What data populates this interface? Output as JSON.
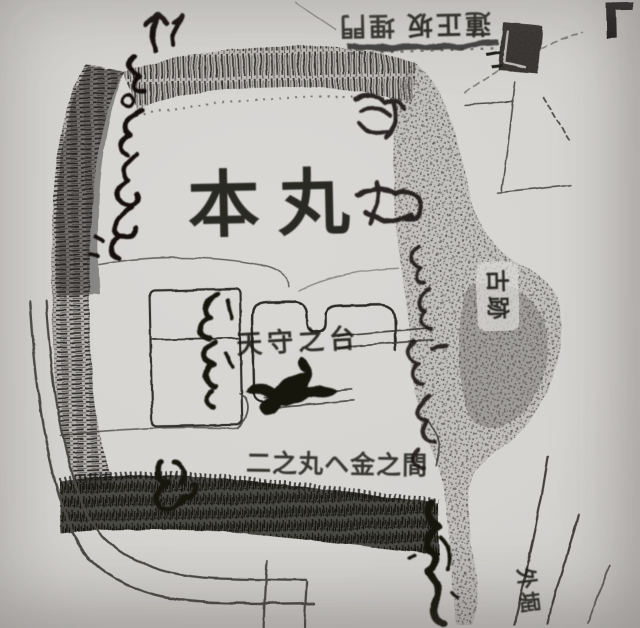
{
  "page": {
    "description": "Photocopy of a hand-drawn historical Japanese castle map (photographed page)",
    "paper_color": "#d6d4d1",
    "ink_color": "#1e1c19",
    "shading_color": "#55524e"
  },
  "labels": {
    "honmaru": "本丸",
    "tenshu_base": "天守之台",
    "ninomaru_kane_no_ma": "二之丸ヘ金之間",
    "kyuseki": "古跡",
    "sotobori": "外堀",
    "top_note_right": "蓮正坂",
    "top_note_left": "埋門"
  },
  "annotations": {
    "upper_left_cursive": "墨書（判読難）…より本丸へ ↑",
    "hill_side_cursive_upper": "墨書（判読難）段",
    "hill_side_cursive_lower": "墨書（判読難）郭",
    "east_wall_cursive": "墨書（判読難）番所多門",
    "tenshudai_cursive_mark": "墨書（判読難）",
    "storehouse_cursive": "墨書（判読難）矢蔵",
    "south_single_glyph": "墨書（判読難）",
    "south_edge_cursive": "墨書（判読難）…より"
  }
}
